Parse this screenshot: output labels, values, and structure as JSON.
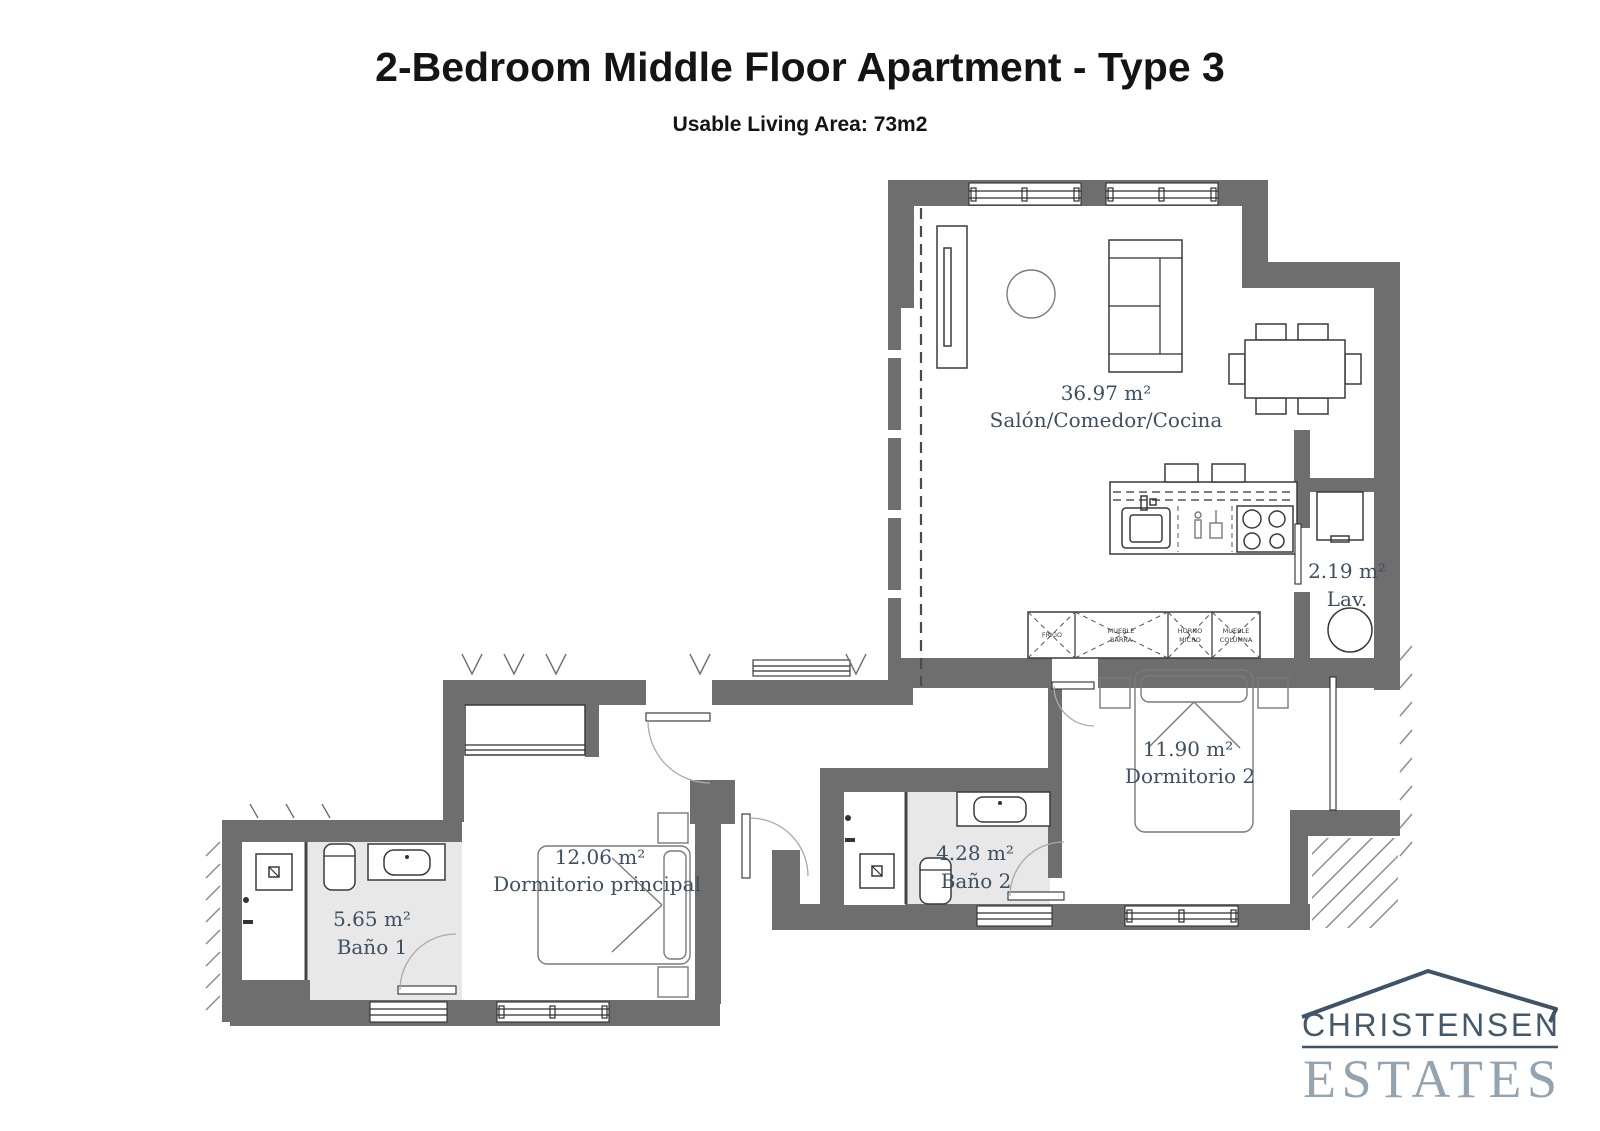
{
  "header": {
    "title": "2-Bedroom Middle Floor Apartment - Type 3",
    "subtitle": "Usable Living Area: 73m2"
  },
  "rooms": {
    "salon": {
      "area": "36.97 m²",
      "name": "Salón/Comedor/Cocina"
    },
    "lav": {
      "area": "2.19 m²",
      "name": "Lav."
    },
    "dormitorio2": {
      "area": "11.90 m²",
      "name": "Dormitorio 2"
    },
    "bano2": {
      "area": "4.28 m²",
      "name": "Baño 2"
    },
    "dormitorio_principal": {
      "area": "12.06 m²",
      "name": "Dormitorio principal"
    },
    "bano1": {
      "area": "5.65 m²",
      "name": "Baño 1"
    }
  },
  "cabinets": [
    {
      "line1": "FRIGO",
      "line2": ""
    },
    {
      "line1": "MUEBLE",
      "line2": "BARRA"
    },
    {
      "line1": "HORNO",
      "line2": "MICRO"
    },
    {
      "line1": "MUEBLE",
      "line2": "COLUMNA"
    }
  ],
  "logo": {
    "name": "CHRISTENSEN",
    "word": "ESTATES"
  },
  "colors": {
    "wall": "#6e6e6e",
    "room_label": "#3d4f63",
    "bath_floor": "#e8e8e8",
    "logo_dark": "#44586b",
    "logo_light": "#93a3b0"
  }
}
